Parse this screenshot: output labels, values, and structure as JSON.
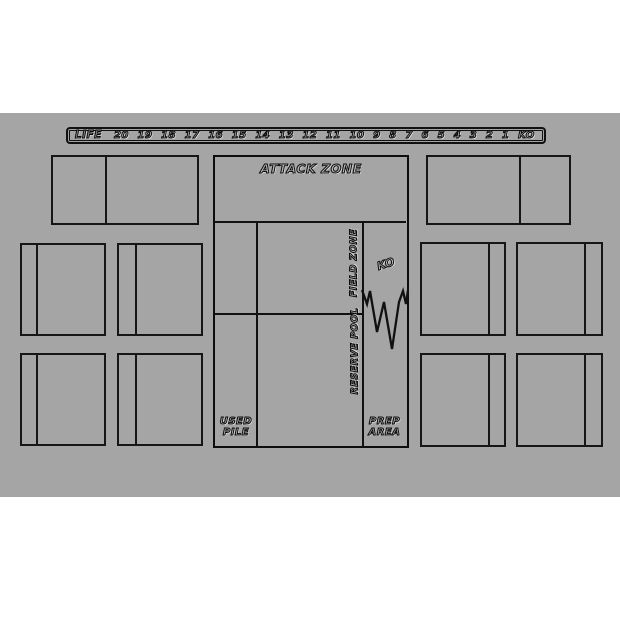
{
  "colors": {
    "mat_background": "#a5a5a5",
    "line": "#111111",
    "page_background": "#ffffff",
    "label_fill": "#b6b6b6"
  },
  "life_track": {
    "label": "LIFE",
    "cells": [
      "20",
      "19",
      "18",
      "17",
      "16",
      "15",
      "14",
      "13",
      "12",
      "11",
      "10",
      "9",
      "8",
      "7",
      "6",
      "5",
      "4",
      "3",
      "2",
      "1",
      "KO"
    ]
  },
  "board": {
    "attack_zone_label": "ATTACK ZONE",
    "field_zone_label": "FIELD ZONE",
    "ko_label": "KO",
    "reserve_pool_label": "RESERVE POOL",
    "used_pile_lines": [
      "USED",
      "PILE"
    ],
    "prep_area_lines": [
      "PREP",
      "AREA"
    ]
  }
}
